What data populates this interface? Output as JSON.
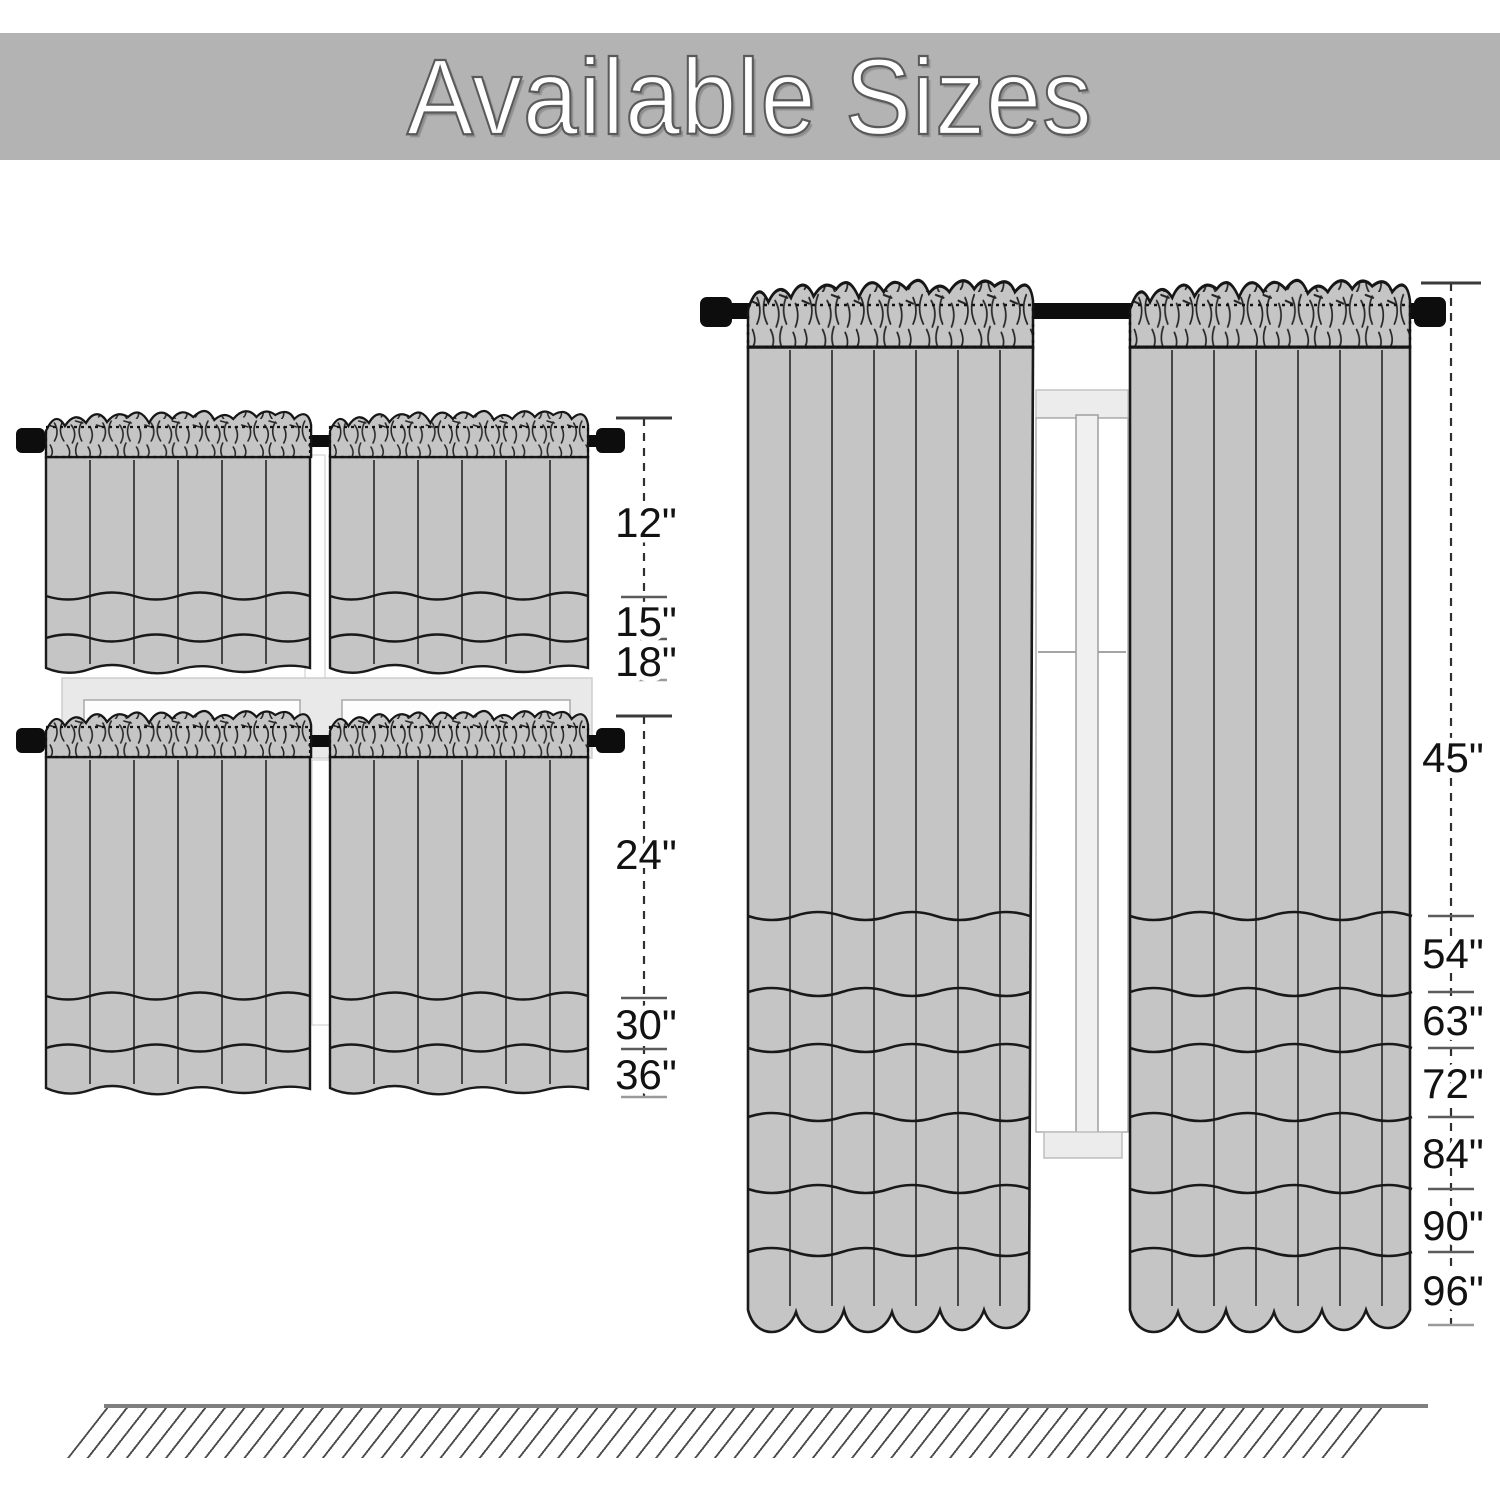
{
  "title": "Available Sizes",
  "banner": {
    "background": "#b3b3b3",
    "text_color": "#ffffff",
    "outline_color": "#5a5a5a"
  },
  "sizes": {
    "tier_top": [
      "12\"",
      "15\"",
      "18\""
    ],
    "tier_bottom": [
      "24\"",
      "30\"",
      "36\""
    ],
    "panels": [
      "45\"",
      "54\"",
      "63\"",
      "72\"",
      "84\"",
      "90\"",
      "96\""
    ]
  },
  "diagrams": {
    "tier_top": {
      "type": "kitchen-tier-curtain-pair",
      "lengths_shown": [
        "12\"",
        "15\"",
        "18\""
      ]
    },
    "tier_bottom": {
      "type": "kitchen-tier-curtain-pair",
      "lengths_shown": [
        "24\"",
        "30\"",
        "36\""
      ]
    },
    "panels": {
      "type": "window-panel-curtain-pair",
      "lengths_shown": [
        "45\"",
        "54\"",
        "63\"",
        "72\"",
        "84\"",
        "90\"",
        "96\""
      ]
    }
  },
  "colors": {
    "curtain_fill": "#c5c5c5",
    "curtain_outline": "#1a1a1a",
    "rod": "#0d0d0d",
    "window_frame": "#ececec",
    "measure_line": "#3c3c3c",
    "floor": "#7f7f7f"
  }
}
